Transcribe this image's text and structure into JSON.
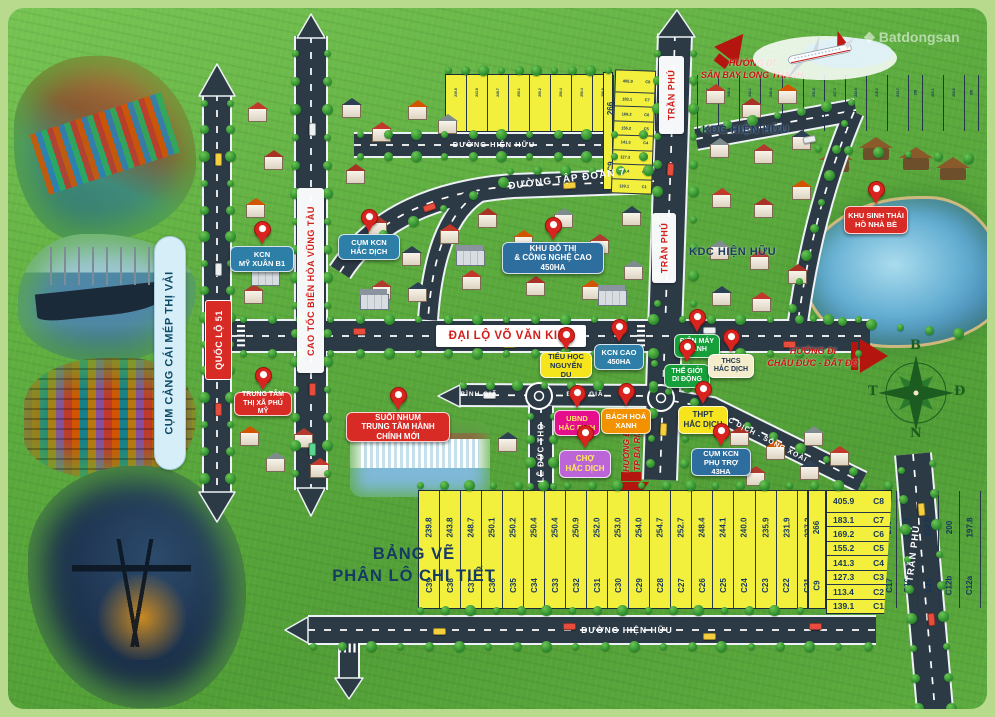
{
  "watermark": {
    "logo_glyph": "◆",
    "brand": "Batdongsan"
  },
  "port_label": "CỤM CẢNG CÁI MÉP THỊ VẢI",
  "title": {
    "line1": "BẢNG VẼ",
    "line2": "PHÂN LÔ CHI TIẾT"
  },
  "compass": {
    "north": "B",
    "east": "Đ",
    "south": "N",
    "west": "T"
  },
  "roads": {
    "ql51": "QUỐC LỘ 51",
    "caotoc": "CAO TỐC BIÊN HÒA VŨNG TÀU",
    "tranphu": "TRẦN PHÚ",
    "dailo": "ĐẠI LỘ VÕ VĂN KIỆT",
    "tapdoan7": "ĐƯỜNG TẬP ĐOÀN 7",
    "hienhuu": "ĐƯỜNG HIỆN HỮU",
    "leductho": "LÊ ĐỨC THỌ",
    "binhgia": "BÌNH GIÃ",
    "hacdich_songxoai": "HẮC DỊCH - SÔNG XOÀI"
  },
  "areas": {
    "kdc": "KDC HIỆN HỮU"
  },
  "directions": {
    "airport1": "HƯỚNG ĐI",
    "airport2": "SÂN BAY LONG THÀNH",
    "chauduc1": "HƯỚNG ĐI",
    "chauduc2": "CHÂU ĐỨC - ĐẤT ĐỎ",
    "baria1": "HƯỚNG ĐI",
    "baria2": "TP BÀ RỊA"
  },
  "pois": [
    {
      "id": "kcn-my-xuan-b1",
      "lines": [
        "KCN",
        "MỸ XUÂN B1"
      ],
      "bg": "#2e7fa8",
      "fg": "#ffffff"
    },
    {
      "id": "cum-kcn-hac-dich",
      "lines": [
        "CỤM KCN",
        "HẮC DỊCH"
      ],
      "bg": "#2e7fa8",
      "fg": "#ffffff"
    },
    {
      "id": "khu-do-thi",
      "lines": [
        "KHU ĐÔ THỊ",
        "& CÔNG NGHỆ CAO 450HA"
      ],
      "bg": "#2e6e9e",
      "fg": "#ffffff"
    },
    {
      "id": "kcn-cao-450ha",
      "lines": [
        "KCN CAO",
        "450HA"
      ],
      "bg": "#2e7fa8",
      "fg": "#ffffff"
    },
    {
      "id": "dien-may-xanh",
      "lines": [
        "ĐIỆN MÁY",
        "XANH"
      ],
      "bg": "#169f3a",
      "fg": "#ffffff"
    },
    {
      "id": "the-gioi-di-dong",
      "lines": [
        "THẾ GIỚI",
        "DI ĐỘNG"
      ],
      "bg": "#169f3a",
      "fg": "#ffffff"
    },
    {
      "id": "thcs-hac-dich",
      "lines": [
        "THCS",
        "HẮC DỊCH"
      ],
      "bg": "#f4eccb",
      "fg": "#1c3350"
    },
    {
      "id": "bach-hoa-xanh",
      "lines": [
        "BÁCH HOÁ",
        "XANH"
      ],
      "bg": "#f39200",
      "fg": "#ffffff"
    },
    {
      "id": "ubnd-hac-dich",
      "lines": [
        "UBND",
        "HẮC DỊCH"
      ],
      "bg": "#e50f8d",
      "fg": "#ffe95e"
    },
    {
      "id": "cho-hac-dich",
      "lines": [
        "CHỢ",
        "HẮC DỊCH"
      ],
      "bg": "#bb65d9",
      "fg": "#ffe95e"
    },
    {
      "id": "thpt-hac-dich",
      "lines": [
        "THPT",
        "HẮC DỊCH"
      ],
      "bg": "#f6e41c",
      "fg": "#1c3350"
    },
    {
      "id": "cum-kcn-phu-tro",
      "lines": [
        "CỤM KCN",
        "PHỤ TRỢ 43HA"
      ],
      "bg": "#2e6e9e",
      "fg": "#ffffff"
    },
    {
      "id": "tieu-hoc-nguyen-du",
      "lines": [
        "TIỂU HỌC",
        "NGUYỄN DU"
      ],
      "bg": "#f6e41c",
      "fg": "#1c3350"
    },
    {
      "id": "trung-tam-thi-xa-phu-my",
      "lines": [
        "TRUNG TÂM",
        "THỊ XÃ PHÚ MỸ"
      ],
      "bg": "#d92b25",
      "fg": "#ffffff"
    },
    {
      "id": "suoi-nhum",
      "lines": [
        "SUỐI NHUM",
        "TRUNG TÂM HÀNH CHÍNH MỚI"
      ],
      "bg": "#d92b25",
      "fg": "#ffffff"
    },
    {
      "id": "khu-sinh-thai-ho-nha-be",
      "lines": [
        "KHU SINH THÁI",
        "HỒ NHÀ BÈ"
      ],
      "bg": "#d92b25",
      "fg": "#ffffff"
    }
  ],
  "plots": {
    "row": [
      {
        "id": "C39",
        "area": "239.8"
      },
      {
        "id": "C38",
        "area": "243.8"
      },
      {
        "id": "C37",
        "area": "248.7"
      },
      {
        "id": "C36",
        "area": "250.1"
      },
      {
        "id": "C35",
        "area": "250.2"
      },
      {
        "id": "C34",
        "area": "250.4"
      },
      {
        "id": "C33",
        "area": "250.4"
      },
      {
        "id": "C32",
        "area": "250.9"
      },
      {
        "id": "C31",
        "area": "252.0"
      },
      {
        "id": "C30",
        "area": "253.0"
      },
      {
        "id": "C29",
        "area": "254.0"
      },
      {
        "id": "C28",
        "area": "254.7"
      },
      {
        "id": "C27",
        "area": "252.7"
      },
      {
        "id": "C26",
        "area": "248.4"
      },
      {
        "id": "C25",
        "area": "244.1"
      },
      {
        "id": "C24",
        "area": "240.0"
      },
      {
        "id": "C23",
        "area": "235.9"
      },
      {
        "id": "C22",
        "area": "231.9"
      },
      {
        "id": "C21",
        "area": "227.3"
      },
      {
        "id": "C20",
        "area": "222.8"
      },
      {
        "id": "C19",
        "area": "218.2"
      },
      {
        "id": "C18",
        "area": "213.7"
      },
      {
        "id": "C17",
        "area": "209"
      },
      {
        "id": "C16",
        "area": "205.1"
      },
      {
        "id": "C15",
        "area": "202.0"
      },
      {
        "id": "C12b",
        "area": "200"
      },
      {
        "id": "C12a",
        "area": "197.8"
      },
      {
        "id": "C12",
        "area": "195.8"
      },
      {
        "id": "C11",
        "area": "193.1"
      },
      {
        "id": "C10",
        "area": "193.9"
      }
    ],
    "corner": {
      "id": "C9",
      "area": "266"
    },
    "stack": [
      {
        "id": "C8",
        "area": "405.9"
      },
      {
        "id": "C7",
        "area": "183.1"
      },
      {
        "id": "C6",
        "area": "169.2"
      },
      {
        "id": "C5",
        "area": "155.2"
      },
      {
        "id": "C4",
        "area": "141.3"
      },
      {
        "id": "C3",
        "area": "127.3"
      },
      {
        "id": "C2",
        "area": "113.4"
      },
      {
        "id": "C1",
        "area": "139.1"
      }
    ]
  },
  "colors": {
    "poi_pin": "#d9231e",
    "road": "#2c3a46",
    "plot_fill": "#f3ef3d",
    "accent_red": "#c6150f",
    "navy": "#14365c"
  }
}
